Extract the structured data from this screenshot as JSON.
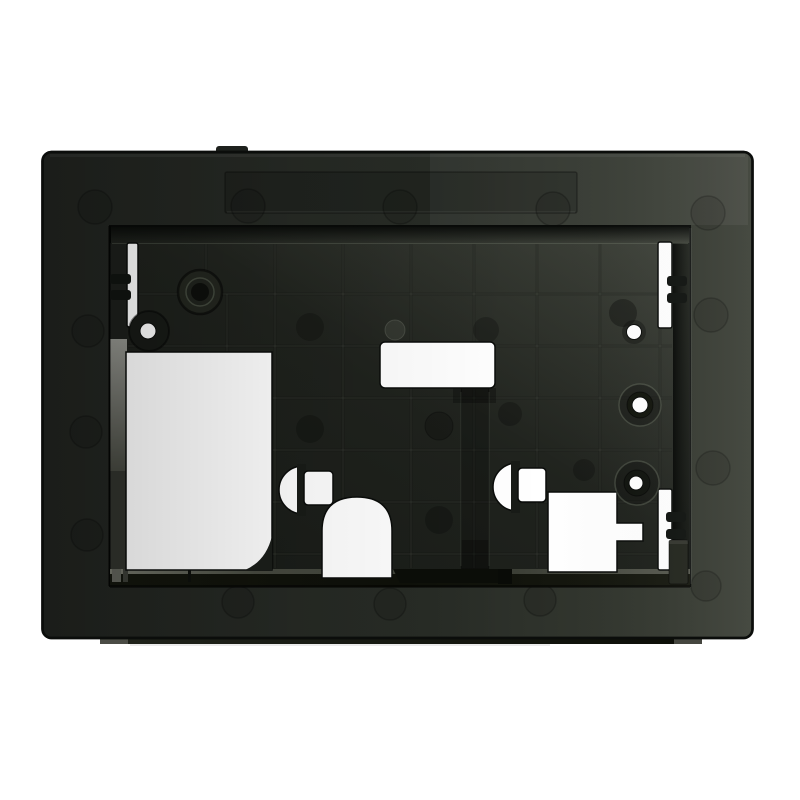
{
  "description": "Product photo of a dark black-green plastic recessed mounting frame (in-wall bracket) with a ribbed back panel, keyhole mounting slots, snap clips, screw bosses with pin holes, rectangular and arched cable cut-outs, shown on a plain white background.",
  "canvas": {
    "width": 800,
    "height": 800
  },
  "palette": {
    "bg": "#ffffff",
    "outline": "#0b0d0b",
    "face-l": "#212420",
    "face-m": "#282c26",
    "face-r": "#3b3f36",
    "panel-l": "#171a16",
    "panel-m": "#1f221d",
    "panel-r": "#31342d",
    "dark": "#0a0c0a",
    "wall-gray": "#92938d",
    "wall-gray-d": "#45473f",
    "shelf-l": "#75776c",
    "shelf-d": "#13150d",
    "flange": "#1f221a",
    "band": "#4b4c45",
    "white": "#ffffff",
    "clip": "#111411",
    "boss": "#0d0f0c",
    "col-foot": "#1b1e1a"
  },
  "parts": {
    "photo": "black plastic recessed mounting frame on white background",
    "frame-body": "outer frame body with beveled face",
    "bottom-flange": "bottom mounting flange with angled end faces",
    "top-recess": "recessed strip on top frame face",
    "back-panel": "ribbed back panel",
    "rib-grid": "reinforcement rib grid",
    "cutouts": "mounting cut-outs, slots and arched cable opening",
    "bosses": "screw bosses and pin holes",
    "shelf": "bottom inner ledge",
    "marks": "ejector pin marks"
  }
}
